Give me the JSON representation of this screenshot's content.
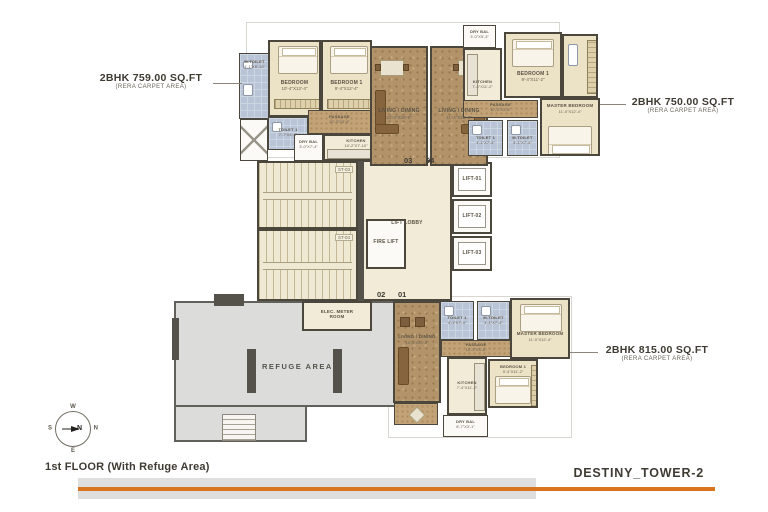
{
  "page": {
    "floor_title": "1st FLOOR (With Refuge Area)",
    "tower_title": "DESTINY_TOWER-2",
    "accent_orange": "#d8731e",
    "bar_gray": "#dedede"
  },
  "unit_labels": {
    "u759": {
      "area": "2BHK 759.00 SQ.FT",
      "sub": "(RERA CARPET AREA)"
    },
    "u750": {
      "area": "2BHK 750.00 SQ.FT",
      "sub": "(RERA CARPET AREA)"
    },
    "u815": {
      "area": "2BHK 815.00 SQ.FT",
      "sub": "(RERA CARPET AREA)"
    }
  },
  "flat_numbers": {
    "n03": "03",
    "n04": "04",
    "n02": "02",
    "n01": "01"
  },
  "core": {
    "st03": "ST-03",
    "st04": "ST-04",
    "fire_lift": "FIRE LIFT",
    "lift_lobby": "LIFT LOBBY",
    "lift01": "LIFT-01",
    "lift02": "LIFT-02",
    "lift03": "LIFT-03",
    "elec": "ELEC. METER ROOM",
    "refuge": "REFUGE AREA"
  },
  "compass": {
    "n": "N",
    "e": "E",
    "s": "S",
    "w": "W"
  },
  "rooms": {
    "tl_mtoilet": {
      "name": "M.TOILET",
      "dims": "4'-1\"X8'-10\""
    },
    "tl_bedroom": {
      "name": "BEDROOM",
      "dims": "10'-4\"X12'-4\""
    },
    "tl_bedroom1": {
      "name": "BEDROOM 1",
      "dims": "9'-4\"X12'-4\""
    },
    "tl_toilet1": {
      "name": "TOILET 1",
      "dims": "7'-7\"X4'-4\""
    },
    "tl_passage": {
      "name": "PASSAGE",
      "dims": "10'-3\"X3'-6\""
    },
    "tl_drybal": {
      "name": "DRY BAL",
      "dims": "3'-0\"X7'-4\""
    },
    "tl_kitchen": {
      "name": "KITCHEN",
      "dims": "10'-2\"X7'-10\""
    },
    "tl_living": {
      "name": "LIVING / DINING",
      "dims": "10'-4\"X20'-0\""
    },
    "tr_living": {
      "name": "LIVING / DINING",
      "dims": "11'-4\"X20'-0\""
    },
    "tr_drybal": {
      "name": "DRY BAL",
      "dims": "3'-0\"X5'-3\""
    },
    "tr_kitchen": {
      "name": "KITCHEN",
      "dims": "7'-4\"X11'-2\""
    },
    "tr_bedroom1": {
      "name": "BEDROOM 1",
      "dims": "9'-4\"X11'-2\""
    },
    "tr_passage": {
      "name": "PASSAGE",
      "dims": "10'-3\"X3'-6\""
    },
    "tr_master": {
      "name": "MASTER BEDROOM",
      "dims": "11'-0\"X12'-4\""
    },
    "tr_toilet1": {
      "name": "TOILET 1",
      "dims": "4'-1\"X7'-4\""
    },
    "tr_mtoilet": {
      "name": "M.TOILET",
      "dims": "4'-1\"X7'-4\""
    },
    "b_living": {
      "name": "LIVING / DINING",
      "dims": "10'-4\"X20'-0\""
    },
    "b_toilet1": {
      "name": "TOILET 1",
      "dims": "4'-1\"X7'-4\""
    },
    "b_mtoilet": {
      "name": "M.TOILET",
      "dims": "4'-1\"X7'-4\""
    },
    "b_master": {
      "name": "MASTER BEDROOM",
      "dims": "11'-0\"X12'-4\""
    },
    "b_passage": {
      "name": "PASSAGE",
      "dims": "10'-3\"X3'-6\""
    },
    "b_kitchen": {
      "name": "KITCHEN",
      "dims": "7'-4\"X11'-2\""
    },
    "b_bedroom1": {
      "name": "BEDROOM 1",
      "dims": "9'-4\"X11'-2\""
    },
    "b_drybal": {
      "name": "DRY BAL",
      "dims": "8'-7\"X3'-1\""
    }
  }
}
